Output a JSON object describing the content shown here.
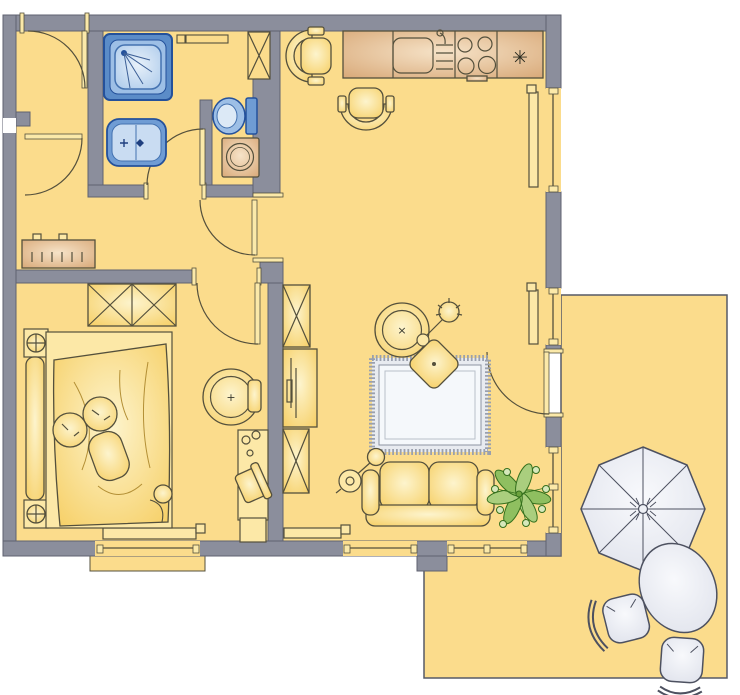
{
  "plan": {
    "kind": "apartment-floor-plan",
    "rooms": [
      {
        "id": "vestibule",
        "label": "entrance vestibule"
      },
      {
        "id": "hallway",
        "label": "hallway"
      },
      {
        "id": "bathroom",
        "label": "bathroom"
      },
      {
        "id": "kitchen",
        "label": "eat-in kitchen"
      },
      {
        "id": "bedroom",
        "label": "bedroom"
      },
      {
        "id": "living-room",
        "label": "living room"
      },
      {
        "id": "terrace",
        "label": "terrace"
      }
    ],
    "fixtures": {
      "bathroom": [
        "shower",
        "washbasin",
        "toilet",
        "washing-machine",
        "shelf",
        "duct-shaft"
      ],
      "kitchen": [
        "worktop",
        "sink",
        "drainer",
        "stove-4-burners",
        "fridge",
        "chair",
        "chair"
      ],
      "hallway": [
        "sideboard"
      ],
      "bedroom": [
        "double-wardrobe",
        "double-bed",
        "pillows",
        "nightstand-lamp",
        "nightstand-lamp",
        "swivel-armchair",
        "desk",
        "desk-chair",
        "radiator",
        "window"
      ],
      "living_room": [
        "shelf-cabinet",
        "tv-cabinet",
        "shelf-cabinet",
        "armchair",
        "floor-lamp",
        "ottoman",
        "rug",
        "sofa",
        "arc-floor-lamp",
        "plant",
        "radiator",
        "radiator",
        "balcony-door",
        "windows"
      ],
      "terrace": [
        "parasol",
        "oval-table",
        "chair",
        "chair"
      ]
    }
  },
  "symbols": {
    "fridge": "✳",
    "bedroom_armchair_mark": "+",
    "living_armchair_mark": "×"
  },
  "colors": {
    "wall": "#8b8e9c",
    "wall_line": "#5f6270",
    "room": "#fbdc8c",
    "line": "#54503c",
    "blue_line": "#24519b",
    "blue_mid": "#6f9cd4",
    "blue_light": "#c9dcf2",
    "terr_line": "#4d5160",
    "green_dark": "#35701d",
    "outside": "#ffffff"
  }
}
